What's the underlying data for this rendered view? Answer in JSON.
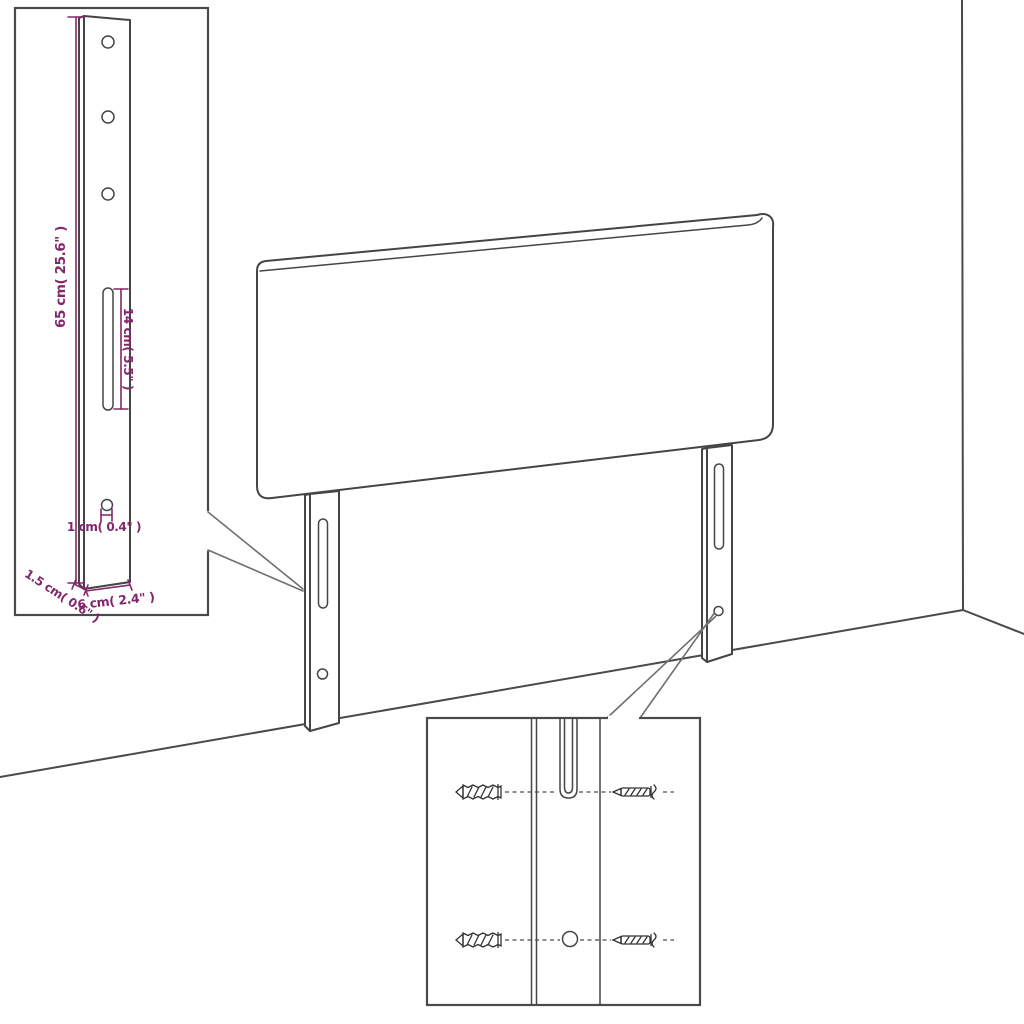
{
  "diagram": {
    "type": "assembly-instruction-drawing",
    "subject": "headboard with two mounting legs, wall corner backdrop, enlarged leg detail and screw/anchor mounting detail",
    "colors": {
      "accent": "#82276B",
      "line": "#454545",
      "box_border": "#4a4a4a",
      "background": "#ffffff"
    },
    "bracket_inset": {
      "dims": {
        "height": "65 cm( 25.6\" )",
        "slot_length": "14 cm( 5.5\" )",
        "hole_diameter": "1 cm( 0.4\" )",
        "thickness": "1.5 cm( 0.6\" )",
        "width": "6 cm( 2.4\" )"
      }
    }
  }
}
